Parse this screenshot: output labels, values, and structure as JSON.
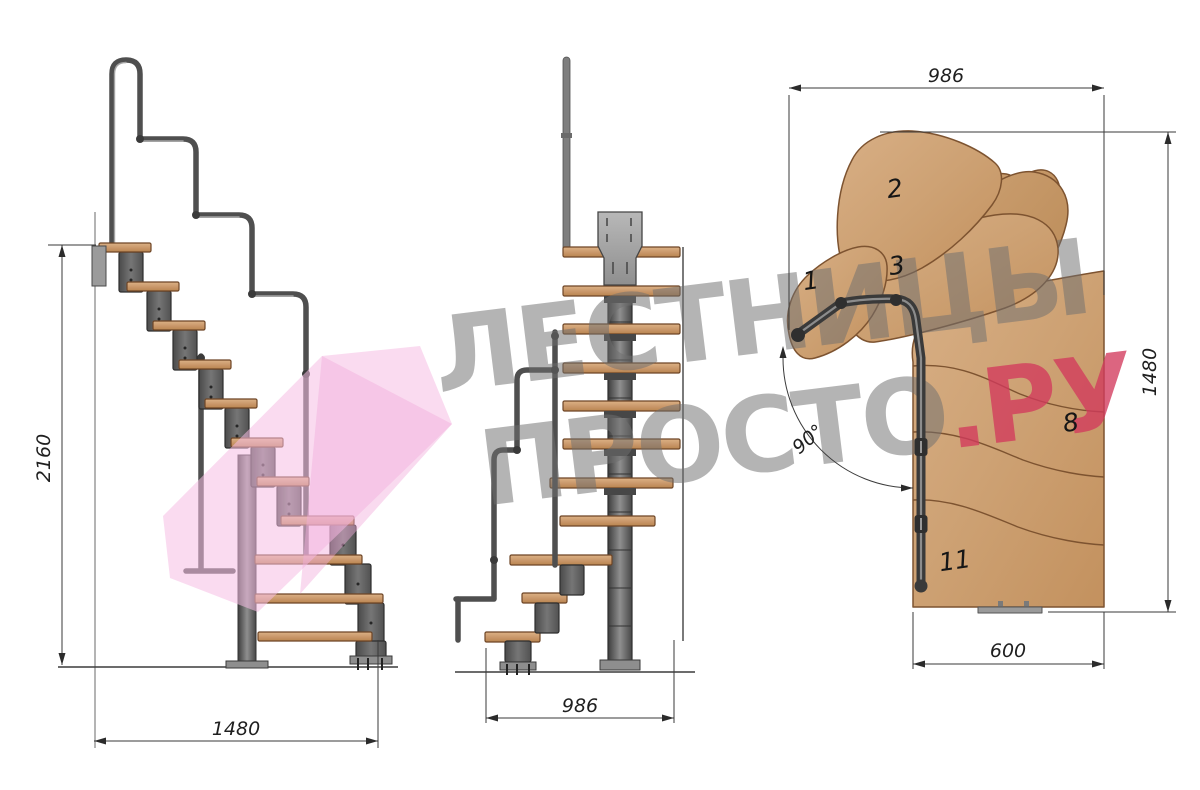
{
  "watermark": {
    "line1": "ЛЕСТНИЦЫ",
    "line2": "ПРОСТО",
    "suffix": ".РУ"
  },
  "side_view": {
    "height": "2160",
    "width": "1480"
  },
  "front_view": {
    "width": "986"
  },
  "plan_view": {
    "width": "986",
    "depth": "1480",
    "flight_width": "600",
    "angle": "90°",
    "steps": [
      {
        "label": "1"
      },
      {
        "label": "2"
      },
      {
        "label": "3"
      },
      {
        "label": "8"
      },
      {
        "label": "11"
      }
    ]
  },
  "colors": {
    "wood": "#cfa077",
    "metal": "#565656",
    "plate": "#a6a6a6",
    "dimension": "#2b2b2b",
    "watermark_gray": "#6f6f6f",
    "watermark_red": "#d23a5c",
    "watermark_pink": "#f5bfe2"
  }
}
